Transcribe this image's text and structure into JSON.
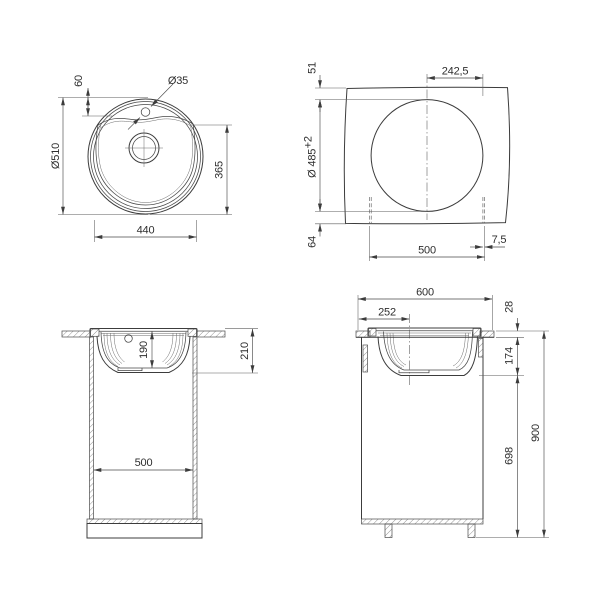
{
  "drawing": {
    "colors": {
      "line": "#3c3c3c",
      "text": "#2e2e2e",
      "background": "#ffffff"
    },
    "dims": {
      "top": {
        "outer_diameter": "Ø510",
        "tap_offset": "60",
        "tap_hole": "Ø35",
        "front_to_bottom": "365",
        "bowl_width": "440"
      },
      "cutout": {
        "front_edge_gap": "51",
        "center_to_edge": "242,5",
        "diameter": "Ø 485",
        "diameter_tolerance": "+2",
        "rear_edge_gap": "64",
        "opening_width": "500",
        "side_gap": "7,5"
      },
      "front": {
        "bowl_depth": "190",
        "overall_depth": "210",
        "cabinet_width": "500"
      },
      "side": {
        "cabinet_depth": "600",
        "bowl_center_offset": "252",
        "countertop_thickness": "28",
        "bowl_below_countertop": "174",
        "under_counter_height": "698",
        "overall_height": "900"
      }
    }
  }
}
